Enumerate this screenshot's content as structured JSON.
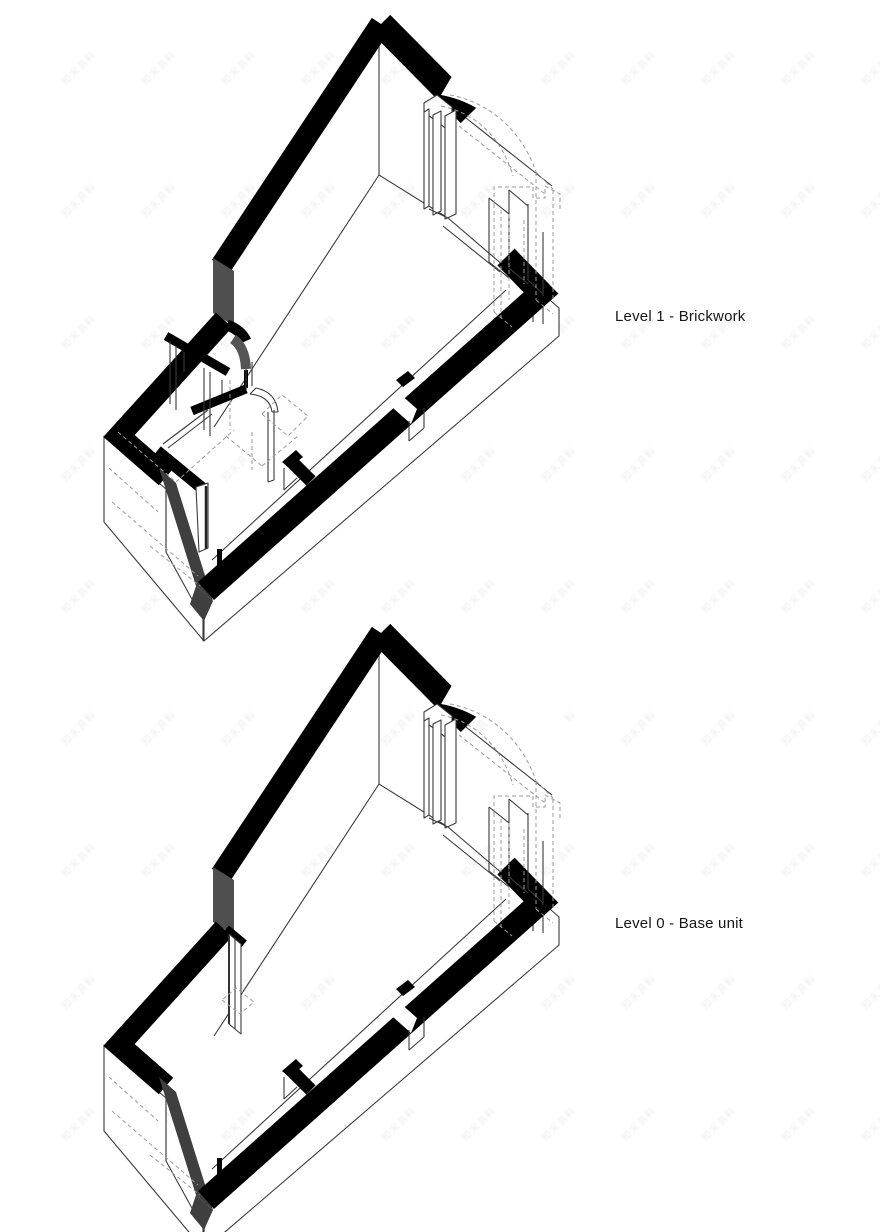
{
  "page": {
    "background": "#ffffff",
    "width_px": 880,
    "height_px": 1232
  },
  "figures": [
    {
      "id": "level-1",
      "label": "Level 1 - Brickwork"
    },
    {
      "id": "level-0",
      "label": "Level 0 - Base unit"
    }
  ],
  "palette": {
    "page_bg": "#ffffff",
    "ink": "#161616",
    "wall_cut": "#000000",
    "wall_end_face": "#3f3f3f",
    "jog_face": "#4f4f4f",
    "outline": "#3a3a3a",
    "hidden_line": "#9b9b9b",
    "wm_color": "#f0eeee"
  },
  "watermark": {
    "text": "知末资料",
    "font_size_px": 10,
    "rotation_deg": -45,
    "x_start": 56,
    "y_start": 60,
    "col_step": 80,
    "row_step": 132,
    "cols": 11,
    "rows": 9
  }
}
